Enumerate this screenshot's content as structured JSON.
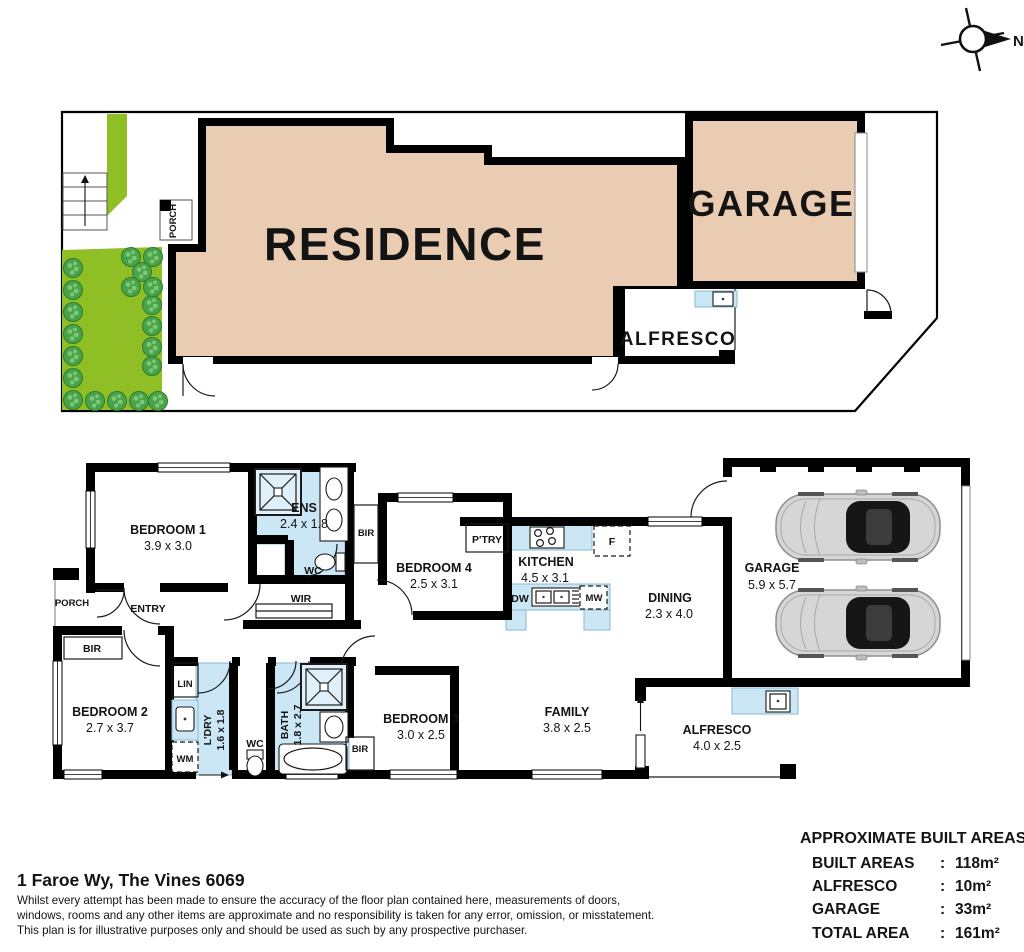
{
  "compass": {
    "label": "N"
  },
  "site_plan": {
    "residence_label": "RESIDENCE",
    "garage_label": "GARAGE",
    "alfresco_label": "ALFRESCO",
    "porch_label": "PORCH"
  },
  "floor_plan": {
    "bedroom1": {
      "name": "BEDROOM 1",
      "dims": "3.9 x 3.0"
    },
    "bedroom2": {
      "name": "BEDROOM 2",
      "dims": "2.7 x 3.7"
    },
    "bedroom3": {
      "name": "BEDROOM 3",
      "dims": "3.0 x 2.5"
    },
    "bedroom4": {
      "name": "BEDROOM 4",
      "dims": "2.5 x 3.1"
    },
    "ens": {
      "name": "ENS",
      "dims": "2.4 x 1.8"
    },
    "kitchen": {
      "name": "KITCHEN",
      "dims": "4.5 x 3.1"
    },
    "dining": {
      "name": "DINING",
      "dims": "2.3 x 4.0"
    },
    "family": {
      "name": "FAMILY",
      "dims": "3.8 x 2.5"
    },
    "garage": {
      "name": "GARAGE",
      "dims": "5.9 x 5.7"
    },
    "alfresco": {
      "name": "ALFRESCO",
      "dims": "4.0 x 2.5"
    },
    "ldry": {
      "name": "L'DRY",
      "dims": "1.6 x 1.8"
    },
    "bath": {
      "name": "BATH",
      "dims": "1.8 x 2.7"
    },
    "labels": {
      "wc": "WC",
      "bir": "BIR",
      "wir": "WIR",
      "lin": "LIN",
      "entry": "ENTRY",
      "porch": "PORCH",
      "ptry": "P'TRY",
      "wm": "WM",
      "dw": "DW",
      "mw": "MW",
      "fridge": "F"
    }
  },
  "areas_table": {
    "title": "APPROXIMATE BUILT AREAS",
    "separator": ":",
    "rows": [
      {
        "label": "BUILT AREAS",
        "value": "118m²"
      },
      {
        "label": "ALFRESCO",
        "value": "10m²"
      },
      {
        "label": "GARAGE",
        "value": "33m²"
      },
      {
        "label": "TOTAL AREA",
        "value": "161m²"
      }
    ]
  },
  "footer": {
    "address": "1 Faroe Wy, The Vines 6069",
    "disclaimer_lines": [
      "Whilst every attempt has been made to ensure the accuracy of the floor plan contained here, measurements of doors,",
      "windows, rooms and any other items are approximate and no responsibility is taken for any error, omission, or misstatement.",
      "This plan is for illustrative purposes only and should be used as such by any prospective purchaser."
    ]
  },
  "colors": {
    "residence_fill": "#e9ccb2",
    "landscape_green": "#8fbe25",
    "wet_area_blue": "#cbe7f6",
    "wall_black": "#000000"
  }
}
